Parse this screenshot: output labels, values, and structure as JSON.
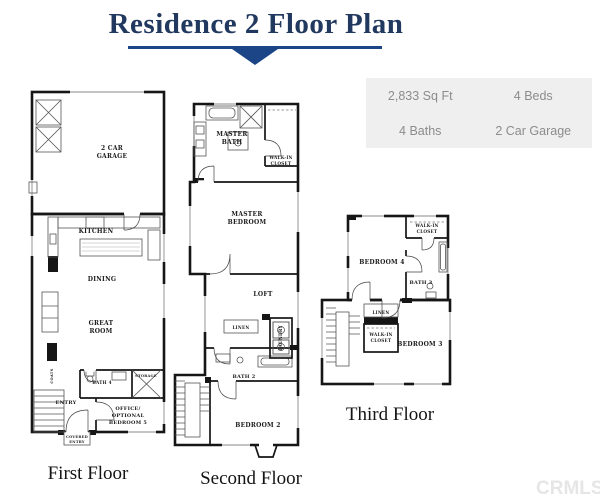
{
  "title": {
    "text": "Residence 2 Floor Plan"
  },
  "colors": {
    "accent": "#1b4586",
    "title_text": "#22395f",
    "info_bg": "#efefef",
    "info_text": "#8c8c8c",
    "plan_line": "#161616",
    "watermark": "#e6e6e6"
  },
  "info_box": {
    "sqft": "2,833 Sq Ft",
    "beds": "4 Beds",
    "baths": "4 Baths",
    "garage": "2 Car Garage"
  },
  "floors": {
    "first": {
      "label": "First Floor",
      "rooms": {
        "garage_l1": "2 CAR",
        "garage_l2": "GARAGE",
        "kitchen": "KITCHEN",
        "dining": "DINING",
        "great_l1": "GREAT",
        "great_l2": "ROOM",
        "bath4": "BATH 4",
        "storage": "STORAGE",
        "entry": "ENTRY",
        "office_l1": "OFFICE/",
        "office_l2": "OPTIONAL",
        "office_l3": "BEDROOM 5",
        "covered_l1": "COVERED",
        "covered_l2": "ENTRY",
        "coats": "COATS"
      }
    },
    "second": {
      "label": "Second Floor",
      "rooms": {
        "master_bath_l1": "MASTER",
        "master_bath_l2": "BATH",
        "wic_l1": "WALK-IN",
        "wic_l2": "CLOSET",
        "master_bed_l1": "MASTER",
        "master_bed_l2": "BEDROOM",
        "loft": "LOFT",
        "linen": "LINEN",
        "laundry": "LAUNDRY",
        "bath2": "BATH 2",
        "bedroom2": "BEDROOM 2"
      }
    },
    "third": {
      "label": "Third Floor",
      "rooms": {
        "bedroom4": "BEDROOM 4",
        "wic_top_l1": "WALK-IN",
        "wic_top_l2": "CLOSET",
        "bath3": "BATH 3",
        "linen": "LINEN",
        "wic_l1": "WALK-IN",
        "wic_l2": "CLOSET",
        "bedroom3": "BEDROOM 3"
      }
    }
  },
  "watermark": {
    "text": "CRMLS"
  }
}
